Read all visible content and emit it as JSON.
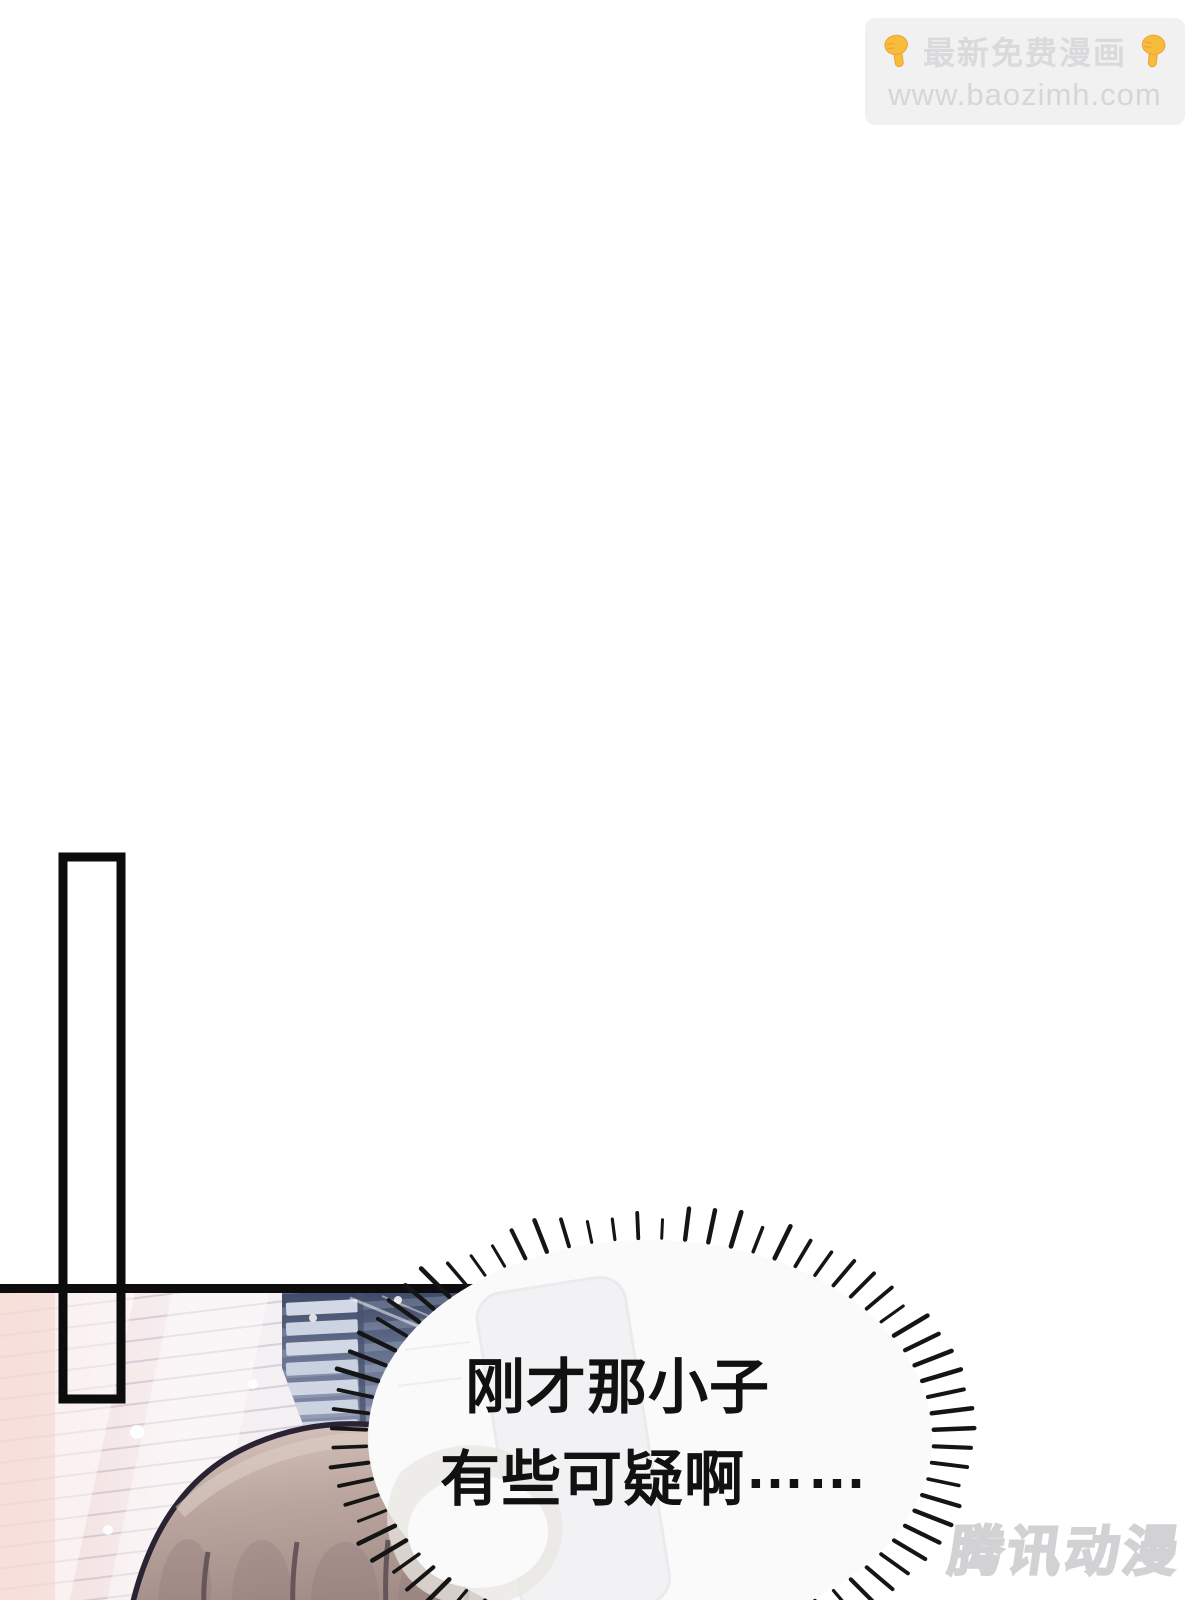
{
  "promo_badge": {
    "title": "最新免费漫画",
    "url": "www.baozimh.com",
    "icon_char": "👇",
    "icon_name": "point-down-hand",
    "icon_color": "#f7bd3a",
    "bg_color": "#f1f1f2",
    "text_color": "#dadadc"
  },
  "speech_bubble": {
    "line1": "刚才那小子",
    "line2": "有些可疑啊",
    "line2_ellipsis": "……",
    "text_color": "#111111",
    "fill_color": "#fafafb"
  },
  "publisher_watermark": {
    "text": "腾讯动漫",
    "color": "#ededef",
    "outline_color": "#d2d2d4"
  },
  "panel": {
    "frame_color": "#0d0d0d",
    "blind_light_colors": [
      "#f4e0dc",
      "#f6f1f4",
      "#e6e4ef"
    ],
    "blind_dark_color": "#4a5472",
    "hair_color": "#b7a29b",
    "hair_outline_color": "#2a2334"
  }
}
